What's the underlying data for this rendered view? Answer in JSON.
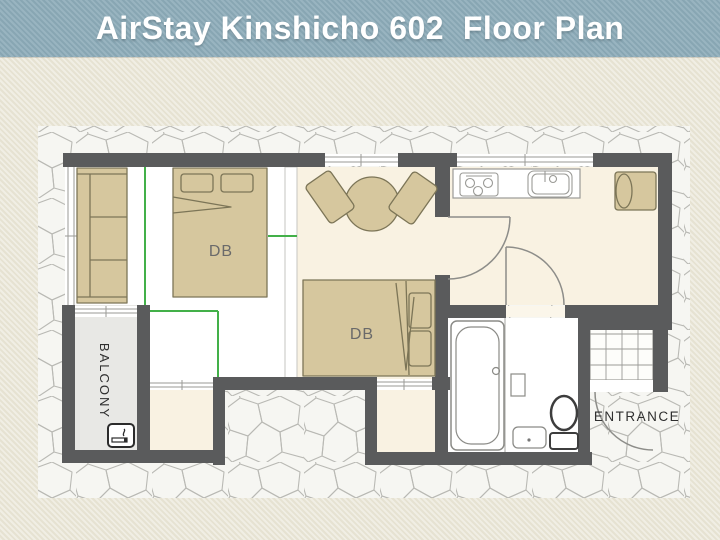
{
  "title_bar": {
    "title": "AirStay Kinshicho 602  Floor Plan"
  },
  "floor_plan": {
    "labels": {
      "bed1_label": "DB",
      "bed2_label": "DB",
      "balcony_label": "BALCONY",
      "entrance_label": "ENTRANCE"
    },
    "icons": {
      "smoking": "smoking-area-icon"
    },
    "colors": {
      "title_bar_bg": "#8dacb9",
      "title_text": "#ffffff",
      "page_background": "#ebe8d9",
      "wall": "#5a5b5c",
      "room_floor_cream": "#f9f2e2",
      "room_floor_white": "#ffffff",
      "balcony_floor": "#e8e8e5",
      "furniture_fill": "#d6c79e",
      "furniture_outline": "#7c7557",
      "partition_green": "#43b049",
      "stone_bg": "#f6f6f2",
      "stone_line": "#b9b9b4"
    }
  }
}
